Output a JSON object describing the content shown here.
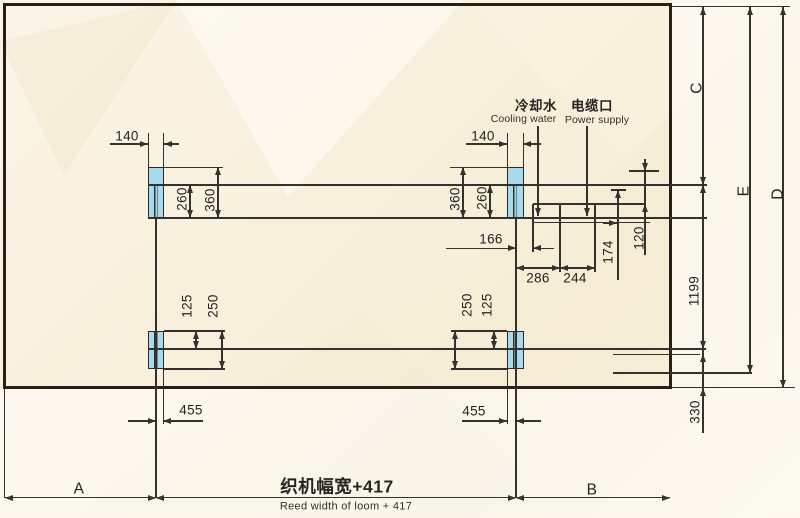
{
  "diagram": {
    "colors": {
      "foot_fill": "#a9d9ec",
      "line": "#34322f",
      "frame": "#281f17"
    },
    "dims": {
      "w140_left": "140",
      "w140_right": "140",
      "v260_left": "260",
      "v360_left": "360",
      "v360_right": "360",
      "v260_right": "260",
      "d166": "166",
      "d286": "286",
      "d244": "244",
      "d174": "174",
      "d120": "120",
      "v125_bl": "125",
      "v250_bl": "250",
      "v250_br": "250",
      "v125_br": "125",
      "v1199": "1199",
      "v330": "330",
      "d455_left": "455",
      "d455_right": "455"
    },
    "letters": {
      "a": "A",
      "b": "B",
      "c": "C",
      "d": "D",
      "e": "E"
    },
    "labels": {
      "cooling_water_cn": "冷却水",
      "cooling_water_en": "Cooling water",
      "power_supply_cn": "电缆口",
      "power_supply_en": "Power supply",
      "reed_width_cn": "织机幅宽+417",
      "reed_width_en": "Reed width of loom + 417"
    }
  }
}
